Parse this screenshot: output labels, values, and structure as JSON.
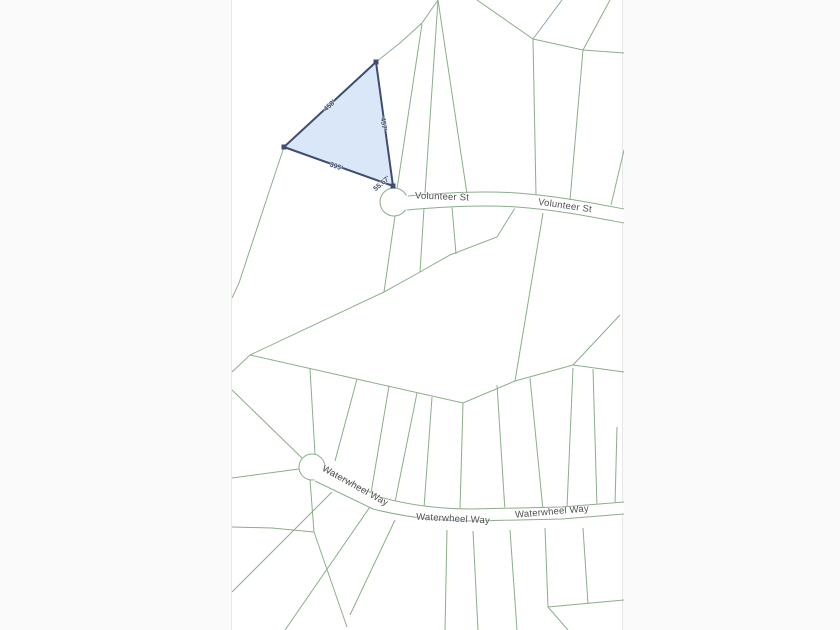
{
  "map": {
    "type": "parcel-plat-map",
    "colors": {
      "page_bg": "#fafafa",
      "map_bg": "#ffffff",
      "parcel_line": "#8aae8a",
      "selected_parcel_fill": "#ccdff7",
      "selected_parcel_stroke": "#3e4d71",
      "street_label": "#4f4f4f",
      "dimension_label": "#3f4e6e"
    },
    "streets": [
      {
        "name": "Volunteer St"
      },
      {
        "name": "Waterwheel Way"
      }
    ],
    "street_labels": [
      {
        "text": "Volunteer St"
      },
      {
        "text": "Volunteer St"
      },
      {
        "text": "Waterwheel Way"
      },
      {
        "text": "Waterwheel Way"
      },
      {
        "text": "Waterwheel Way"
      }
    ],
    "selected_parcel": {
      "shape": "triangle",
      "dimensions": [
        {
          "text": "458'"
        },
        {
          "text": "457'"
        },
        {
          "text": "395'"
        },
        {
          "text": "55.67'"
        }
      ]
    }
  }
}
